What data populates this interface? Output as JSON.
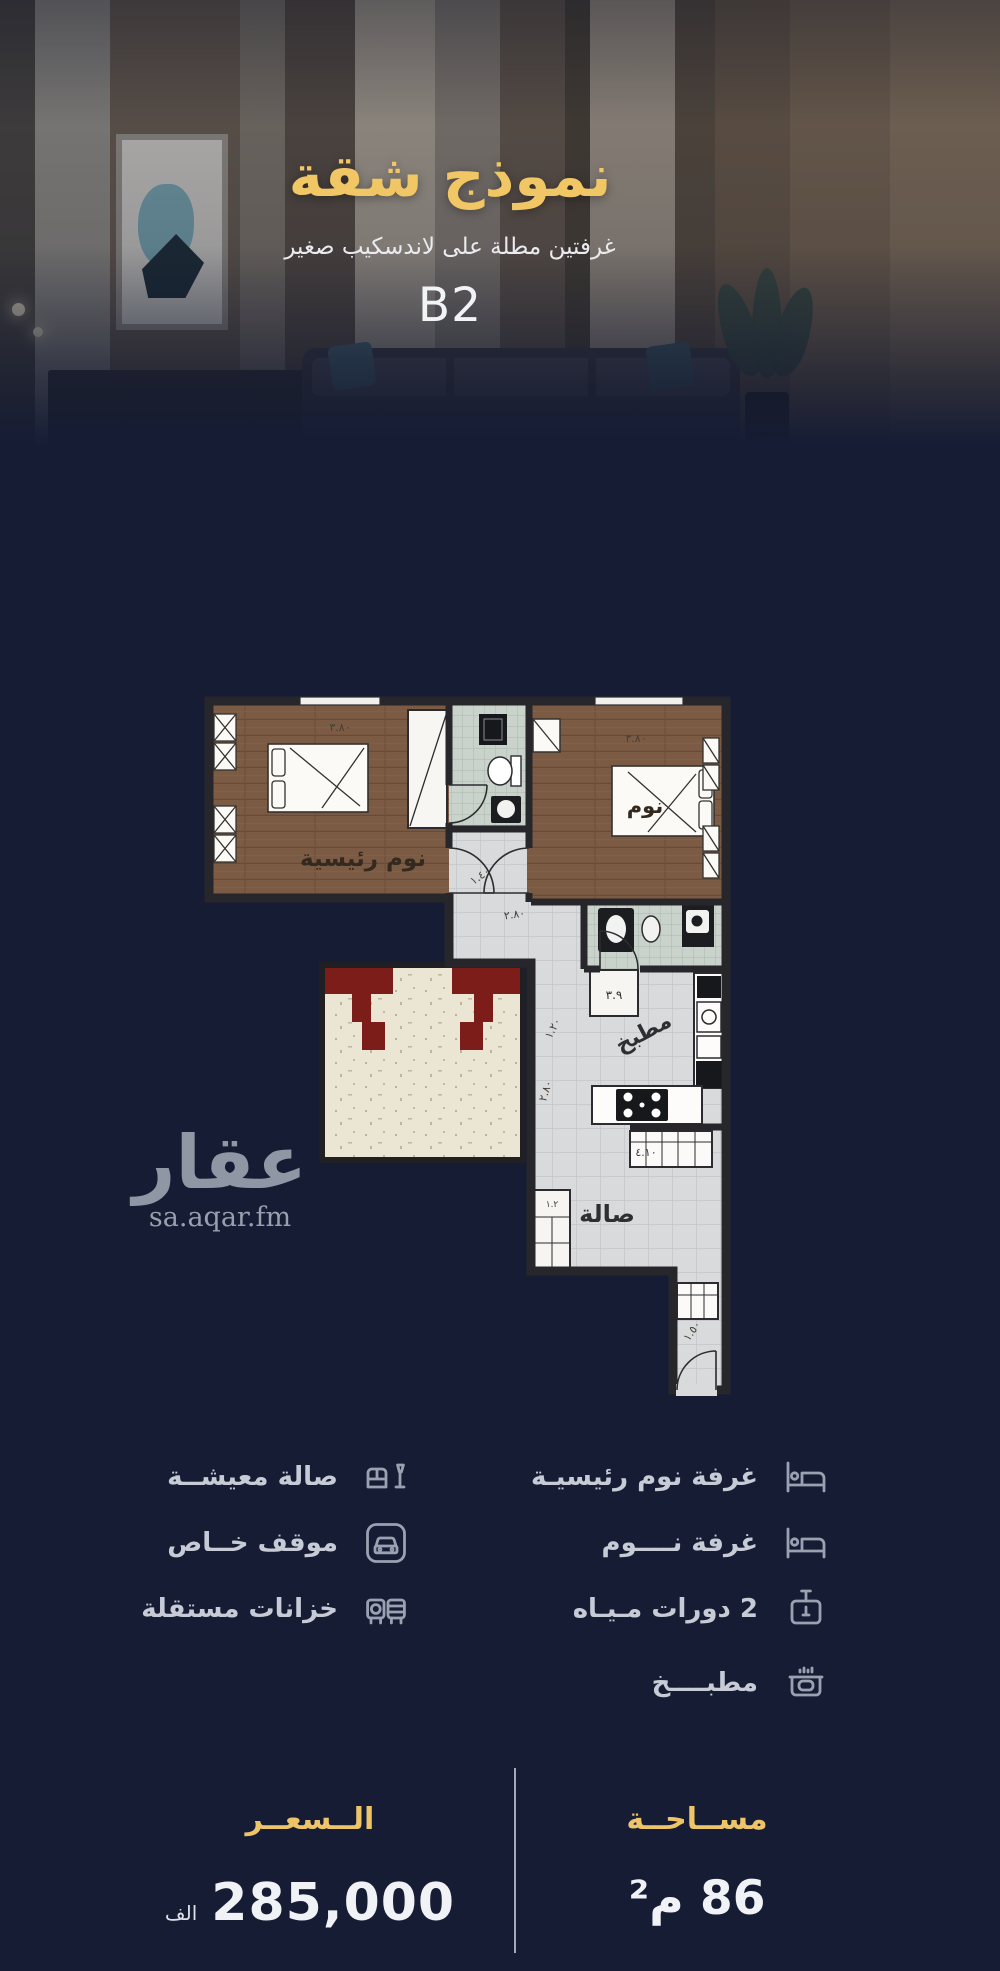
{
  "hero": {
    "title": "نموذج شقة",
    "subtitle": "غرفتين مطلة على لاندسكيب صغير",
    "unit": "B2"
  },
  "watermark": {
    "brand": "عقار",
    "site": "sa.aqar.fm"
  },
  "floor_plan": {
    "rooms": {
      "master_bedroom": "نوم رئيسية",
      "bedroom": "نوم",
      "kitchen": "مطبخ",
      "hall": "صالة"
    },
    "dimensions": {
      "master_width": "٣.٨٠",
      "bedroom_width": "٣.٨٠",
      "hall_width": "٢.٨٠",
      "door": "١.٤٠",
      "shaft": "٣.٩",
      "kitchen_depth": "١.٢٠",
      "kitchen_length": "٢.٨٠",
      "cabinet": "٤.١٠",
      "entrance": "١.٥٠",
      "window": "١.٢"
    }
  },
  "features": {
    "right": [
      {
        "label": "غرفة نوم رئيسيـة",
        "icon": "bed-icon"
      },
      {
        "label": "غرفة نــــوم",
        "icon": "bed-icon"
      },
      {
        "label": "2 دورات مـيـاه",
        "icon": "basin-icon"
      },
      {
        "label": "مطبــــخ",
        "icon": "stove-icon"
      }
    ],
    "left": [
      {
        "label": "صالة معيشــة",
        "icon": "sofa-icon"
      },
      {
        "label": "موقف خــاص",
        "icon": "car-icon"
      },
      {
        "label": "خزانات مستقلة",
        "icon": "tanks-icon"
      }
    ]
  },
  "summary": {
    "price_label": "الــسعــر",
    "price_value": "285,000",
    "price_unit": "الف",
    "area_label": "مســاحــة",
    "area_value": "86 م²"
  },
  "colors": {
    "background": "#151c34",
    "gold": "#f1c766",
    "text": "#eef0f4",
    "muted": "#c6cbd6"
  }
}
